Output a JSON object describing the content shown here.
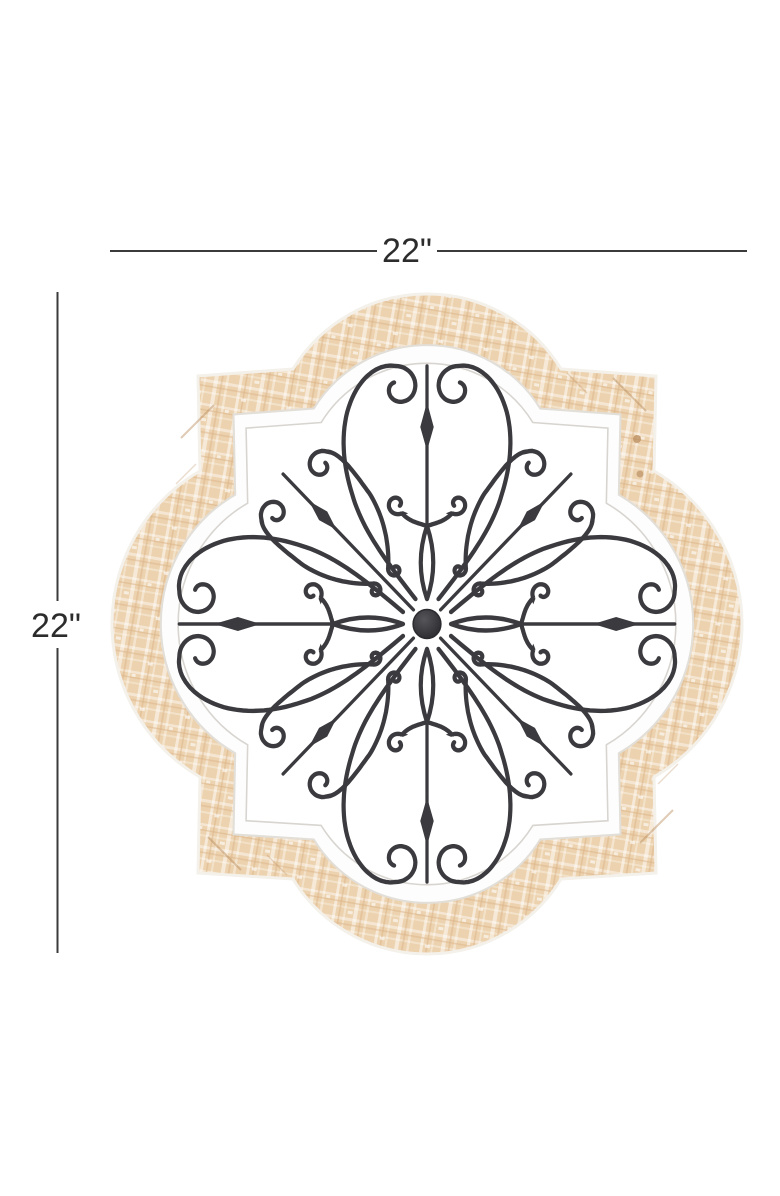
{
  "annotations": {
    "width_label": "22\"",
    "height_label": "22\""
  },
  "colors": {
    "background": "#ffffff",
    "dimension_line": "#3b3b3b",
    "dimension_text": "#2c2c2c",
    "wood_base": "#ecd2ae",
    "wood_streak_light": "#ffffff",
    "wood_streak_dark": "#d9b185",
    "wood_seam": "#b98c5e",
    "frame_white": "#fdfdfd",
    "frame_edge": "#e2ded8",
    "opening_white": "#ffffff",
    "opening_edge": "#d8d5d0",
    "metal": "#3a3a3f",
    "metal_dark": "#2b2b2f"
  }
}
